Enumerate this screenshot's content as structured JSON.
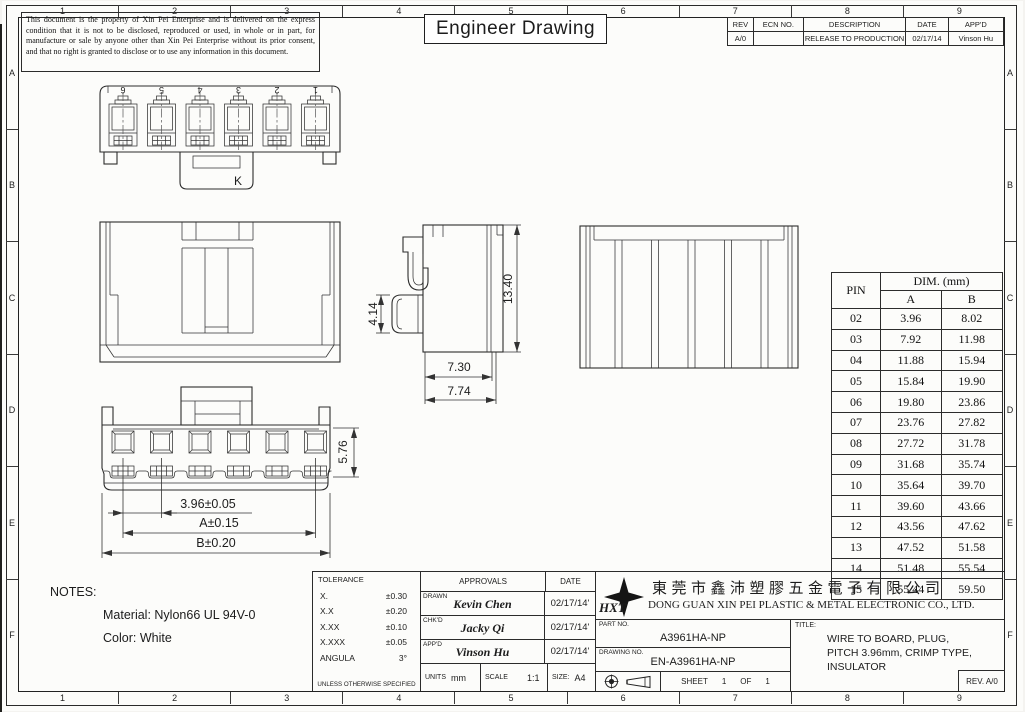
{
  "sheet": {
    "zone_numbers": [
      "1",
      "2",
      "3",
      "4",
      "5",
      "6",
      "7",
      "8",
      "9"
    ],
    "zone_letters": [
      "A",
      "B",
      "C",
      "D",
      "E",
      "F"
    ]
  },
  "disclaimer": "This document is the property of Xin Pei Enterprise and is delivered on the express condition that it is not to be disclosed, reproduced or used, in whole or in part, for manufacture or sale by anyone other than Xin Pei Enterprise without its prior consent, and that no right is granted to disclose or to use any information in this document.",
  "doc_title": "Engineer Drawing",
  "revision_table": {
    "headers": [
      "REV",
      "ECN NO.",
      "DESCRIPTION",
      "DATE",
      "APP'D"
    ],
    "rows": [
      {
        "rev": "A/0",
        "ecn": "",
        "description": "RELEASE TO PRODUCTION",
        "date": "02/17/14",
        "appd": "Vinson Hu"
      }
    ]
  },
  "views": {
    "top_view": {
      "pin_labels": [
        "6",
        "5",
        "4",
        "3",
        "2",
        "1"
      ],
      "key_label": "K"
    },
    "side_view": {
      "dim_height_small": "4.14",
      "dim_height_total": "13.40",
      "dim_width_inner": "7.30",
      "dim_width_outer": "7.74"
    },
    "bottom_view": {
      "dim_pitch": "3.96±0.05",
      "dim_a": "A±0.15",
      "dim_b": "B±0.20",
      "dim_depth": "5.76"
    }
  },
  "pin_table": {
    "col_pin": "PIN",
    "col_dim": "DIM. (mm)",
    "col_a": "A",
    "col_b": "B",
    "rows": [
      {
        "pin": "02",
        "a": "3.96",
        "b": "8.02"
      },
      {
        "pin": "03",
        "a": "7.92",
        "b": "11.98"
      },
      {
        "pin": "04",
        "a": "11.88",
        "b": "15.94"
      },
      {
        "pin": "05",
        "a": "15.84",
        "b": "19.90"
      },
      {
        "pin": "06",
        "a": "19.80",
        "b": "23.86"
      },
      {
        "pin": "07",
        "a": "23.76",
        "b": "27.82"
      },
      {
        "pin": "08",
        "a": "27.72",
        "b": "31.78"
      },
      {
        "pin": "09",
        "a": "31.68",
        "b": "35.74"
      },
      {
        "pin": "10",
        "a": "35.64",
        "b": "39.70"
      },
      {
        "pin": "11",
        "a": "39.60",
        "b": "43.66"
      },
      {
        "pin": "12",
        "a": "43.56",
        "b": "47.62"
      },
      {
        "pin": "13",
        "a": "47.52",
        "b": "51.58"
      },
      {
        "pin": "14",
        "a": "51.48",
        "b": "55.54"
      },
      {
        "pin": "15",
        "a": "55.44",
        "b": "59.50"
      }
    ]
  },
  "notes": {
    "heading": "NOTES:",
    "material": "Material: Nylon66 UL 94V-0",
    "color": "Color: White"
  },
  "tolerance": {
    "heading": "TOLERANCE",
    "rows": [
      [
        "X.",
        "±0.30"
      ],
      [
        "X.X",
        "±0.20"
      ],
      [
        "X.XX",
        "±0.10"
      ],
      [
        "X.XXX",
        "±0.05"
      ],
      [
        "ANGULA",
        "3°"
      ]
    ],
    "footer": "UNLESS OTHERWISE SPECIFIED"
  },
  "approvals": {
    "heading": "APPROVALS",
    "date_heading": "DATE",
    "rows": [
      {
        "role": "DRAWN",
        "name": "Kevin Chen",
        "date": "02/17/14'"
      },
      {
        "role": "CHK'D",
        "name": "Jacky Qi",
        "date": "02/17/14'"
      },
      {
        "role": "APP'D",
        "name": "Vinson Hu",
        "date": "02/17/14'"
      }
    ],
    "units_label": "UNITS",
    "units_value": "mm",
    "scale_label": "SCALE",
    "scale_value": "1:1",
    "size_label": "SIZE:",
    "size_value": "A4"
  },
  "company": {
    "logo_text": "HXT",
    "name_cn": "東莞市鑫沛塑膠五金電子有限公司",
    "name_en": "DONG GUAN XIN PEI PLASTIC & METAL ELECTRONIC CO., LTD."
  },
  "title_block": {
    "part_no_label": "PART NO.",
    "part_no": "A3961HA-NP",
    "drawing_no_label": "DRAWING NO.",
    "drawing_no": "EN-A3961HA-NP",
    "sheet_label": "SHEET",
    "sheet_num": "1",
    "of_label": "OF",
    "sheet_total": "1",
    "title_label": "TITLE:",
    "title_lines": [
      "WIRE TO BOARD, PLUG,",
      "PITCH 3.96mm, CRIMP TYPE,",
      "INSULATOR"
    ],
    "rev_label": "REV. A/0"
  }
}
